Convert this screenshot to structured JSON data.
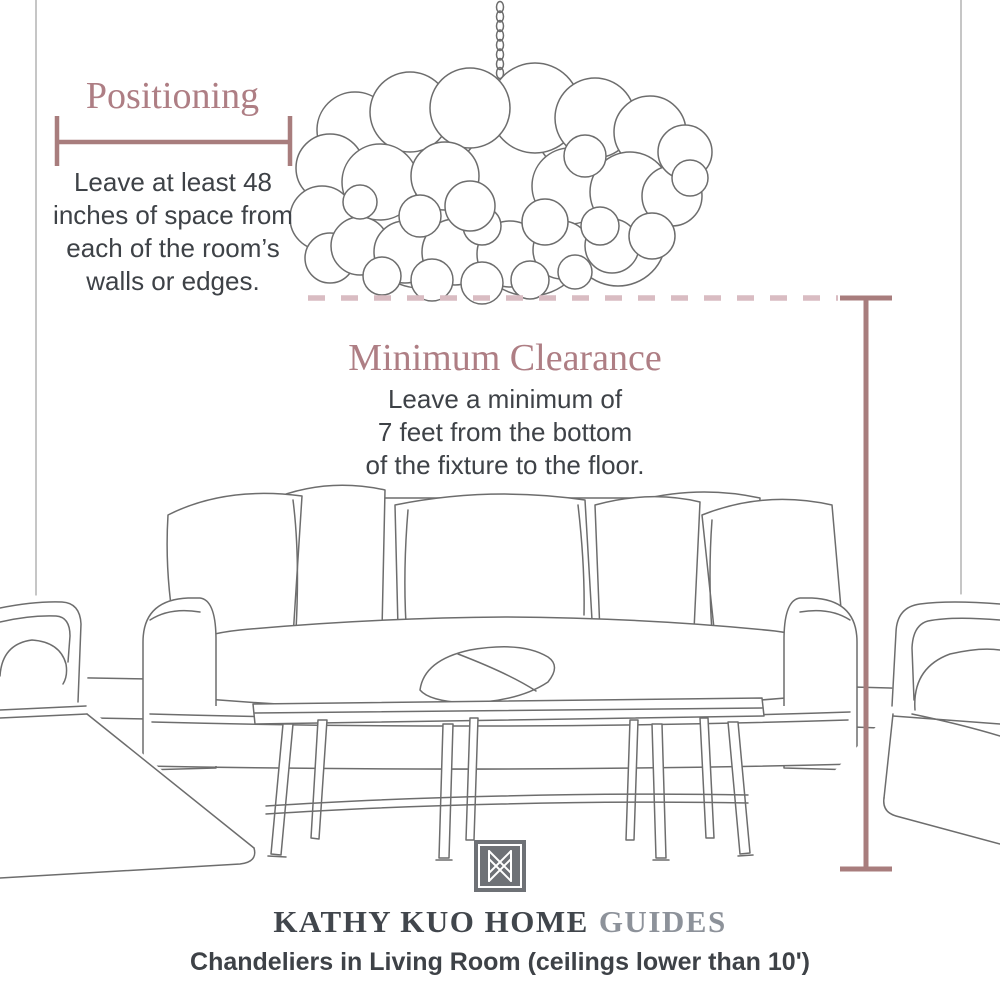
{
  "colors": {
    "accent": "#a87d7d",
    "dash": "#d9bcc2",
    "heading": "#ae7e84",
    "body_text": "#3e4247",
    "sketch": "#6d6d6d",
    "wall": "#a8a8a8",
    "brand_dark": "#41464c",
    "brand_light": "#8d929a",
    "logo_bg": "#6e7176"
  },
  "positioning": {
    "title": "Positioning",
    "lines": [
      "Leave at least 48",
      "inches of space from",
      "each of the room’s",
      "walls or edges."
    ]
  },
  "clearance": {
    "title": "Minimum Clearance",
    "lines": [
      "Leave a minimum of",
      "7 feet from the bottom",
      "of the fixture to the floor."
    ]
  },
  "footer": {
    "brand_main": "KATHY KUO HOME",
    "brand_suffix": "GUIDES",
    "caption": "Chandeliers in Living Room (ceilings lower than 10')"
  },
  "illustration": {
    "items": [
      "bubble-chandelier",
      "sofa-with-pillows",
      "coffee-table-bench",
      "armchair-left",
      "armchair-right"
    ]
  }
}
